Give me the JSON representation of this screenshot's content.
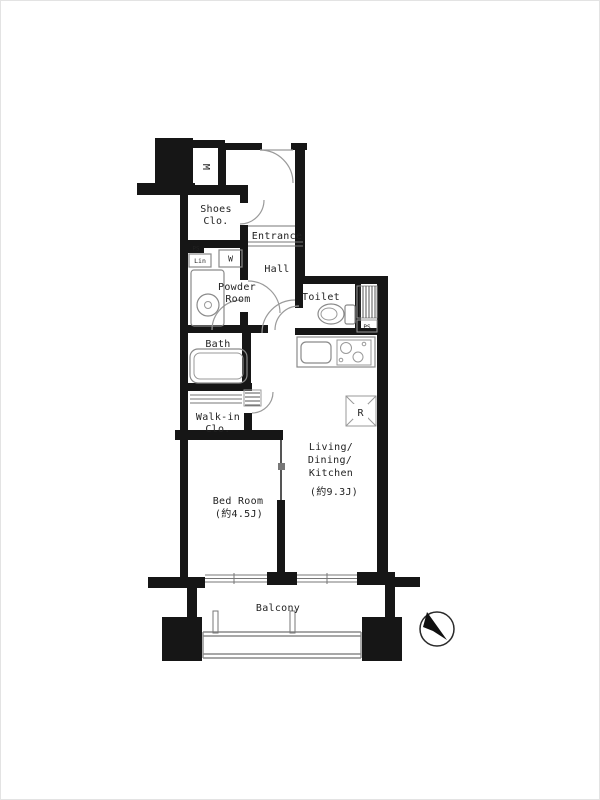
{
  "colors": {
    "wall": "#161616",
    "door_line": "#9a9a9a",
    "text": "#222222",
    "background": "#ffffff"
  },
  "rooms": {
    "shoes_closet": {
      "line1": "Shoes",
      "line2": "Clo."
    },
    "entrance": {
      "label": "Entrance"
    },
    "hall": {
      "label": "Hall"
    },
    "powder_room": {
      "line1": "Powder",
      "line2": "Room"
    },
    "toilet": {
      "label": "Toilet"
    },
    "bath": {
      "label": "Bath"
    },
    "walk_in_closet": {
      "line1": "Walk-in",
      "line2": "Clo."
    },
    "bedroom": {
      "label": "Bed Room",
      "size": "(約4.5J)"
    },
    "ldk": {
      "line1": "Living/",
      "line2": "Dining/",
      "line3": "Kitchen",
      "size": "(約9.3J)"
    },
    "balcony": {
      "label": "Balcony"
    }
  },
  "fixtures": {
    "meter_box": {
      "label": "M"
    },
    "washer": {
      "label": "W"
    },
    "linen": {
      "label": "Lin"
    },
    "pipe_space_entry": {
      "label": "PS"
    },
    "pipe_space_toilet": {
      "label": "PS"
    },
    "refrigerator": {
      "label": "R"
    }
  },
  "icons": {
    "compass": "north-arrow-icon"
  }
}
